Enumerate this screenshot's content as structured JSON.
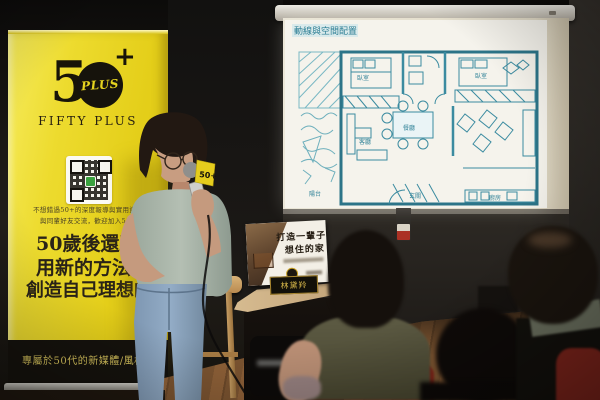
{
  "banner": {
    "logo_5": "5",
    "logo_plus_inner": "PLUS",
    "logo_plus_sign": "+",
    "brand_name": "FIFTY PLUS",
    "info_line1": "不想錯過50+的深度報導與實用資訊",
    "info_line2": "與同輩好友交流，歡迎加入50+",
    "slogan_line1": "50歲後還不賴",
    "slogan_line2": "用新的方法",
    "slogan_line3": "創造自己理想的生活",
    "footer": "專屬於50代的新媒體/風格社群",
    "bg_color": "#e9d722"
  },
  "screen": {
    "slide_title": "動線與空間配置",
    "rooms": {
      "bedroom1": "臥室",
      "bedroom2": "臥室",
      "living": "客廳",
      "dining": "餐廳",
      "kitchen": "廚房",
      "entry": "玄關",
      "balcony": "陽台"
    }
  },
  "book": {
    "title_line1": "打造一輩子",
    "title_line2": "想住的家",
    "name_plate": "林黛羚"
  },
  "microphone": {
    "flag_label": "50+"
  },
  "colors": {
    "plan_ink": "#3b8ba0",
    "chair_red": "#8e2b1f",
    "floor_wood": "#7d5531",
    "banner_yellow": "#e9d722"
  }
}
